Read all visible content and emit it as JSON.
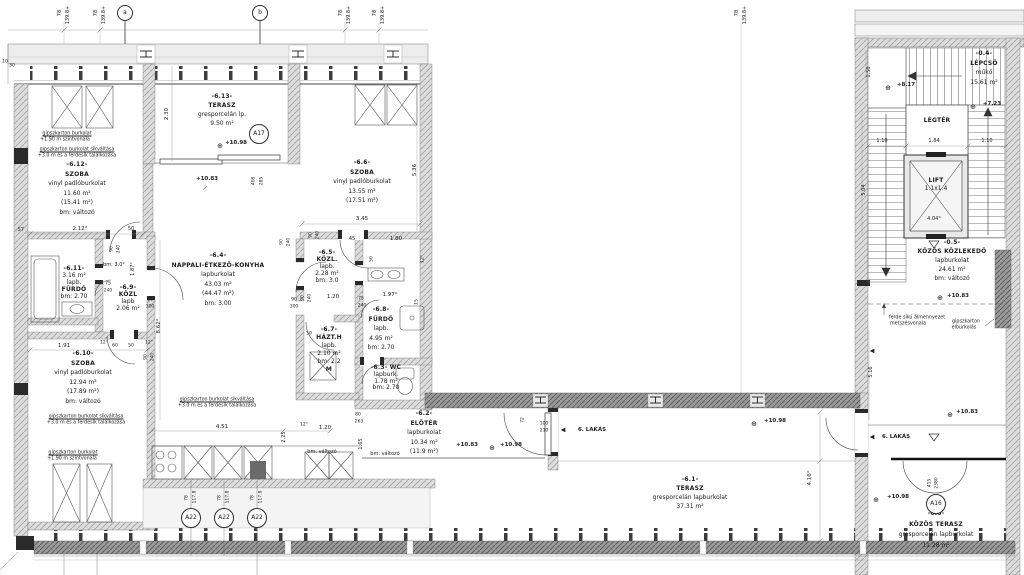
{
  "rooms": [
    {
      "id": "terasz-6-13",
      "x": 222,
      "y": 92,
      "lh": 9,
      "bold": [
        0,
        1
      ],
      "lines": [
        "-6.13-",
        "TERASZ",
        "gresporcelán lp.",
        "9.50 m²"
      ]
    },
    {
      "id": "szoba-6-12",
      "x": 77,
      "y": 160,
      "lh": 9.5,
      "bold": [
        0,
        1
      ],
      "lines": [
        "-6.12-",
        "SZOBA",
        "vinyl padlóburkolat",
        "11.60 m²",
        "(15.41 m²)",
        "bm: változó"
      ]
    },
    {
      "id": "szoba-6-6",
      "x": 362,
      "y": 158,
      "lh": 9.5,
      "bold": [
        0,
        1
      ],
      "lines": [
        "-6.6-",
        "SZOBA",
        "vinyl padlóburkolat",
        "13.55 m²",
        "(17.51 m²)"
      ]
    },
    {
      "id": "nappali-6-4",
      "x": 218,
      "y": 251,
      "lh": 9.5,
      "bold": [
        0,
        1
      ],
      "lines": [
        "-6.4-",
        "NAPPALI-ÉTKEZŐ-KONYHA",
        "lapburkolat",
        "43.03 m²",
        "(44.47 m²)",
        "bm: 3.00"
      ]
    },
    {
      "id": "furdo-6-11",
      "x": 74,
      "y": 265,
      "lh": 7,
      "bold": [
        0,
        3
      ],
      "lines": [
        "-6.11-",
        "3.16 m²",
        "lapb.",
        "FÜRDŐ",
        "bm: 2.70"
      ]
    },
    {
      "id": "kozl-6-9",
      "x": 128,
      "y": 284,
      "lh": 7,
      "bold": [
        0,
        1
      ],
      "lines": [
        "-6.9-",
        "KÖZL",
        "lapb",
        "2.06 m²"
      ]
    },
    {
      "id": "szoba-6-10",
      "x": 83,
      "y": 349,
      "lh": 9.5,
      "bold": [
        0,
        1
      ],
      "lines": [
        "-6.10-",
        "SZOBA",
        "vinyl padlóburkolat",
        "12.94 m²",
        "(17.89 m²)",
        "bm: változó"
      ]
    },
    {
      "id": "kozl-6-5",
      "x": 327,
      "y": 249,
      "lh": 7,
      "bold": [
        0,
        1
      ],
      "lines": [
        "-6.5-",
        "KÖZL.",
        "lapb.",
        "2.28 m²",
        "bm: 3.0"
      ]
    },
    {
      "id": "furdo-6-8",
      "x": 381,
      "y": 305,
      "lh": 9.5,
      "bold": [
        0,
        1
      ],
      "lines": [
        "-6.8-",
        "FÜRDŐ",
        "lapb.",
        "4.95 m²",
        "bm: 2.70"
      ]
    },
    {
      "id": "hazt-6-7",
      "x": 329,
      "y": 326,
      "lh": 8,
      "bold": [
        0,
        1,
        5
      ],
      "lines": [
        "-6.7-",
        "HÁZT.H",
        "lapb.",
        "2.10 m²",
        "bm: 2.2",
        "M"
      ]
    },
    {
      "id": "wc-6-3",
      "x": 386,
      "y": 365,
      "lh": 6.8,
      "bold": [
        0
      ],
      "lines": [
        "-6.3- WC",
        "lapburk.",
        "1.78 m²",
        "bm: 2.70"
      ]
    },
    {
      "id": "eloter-6-2",
      "x": 424,
      "y": 409,
      "lh": 9.5,
      "bold": [
        0,
        1
      ],
      "lines": [
        "-6.2-",
        "ELŐTÉR",
        "lapburkolat",
        "10.34 m²",
        "(11.9 m²)"
      ]
    },
    {
      "id": "terasz-6-1",
      "x": 690,
      "y": 475,
      "lh": 9,
      "bold": [
        0,
        1
      ],
      "lines": [
        "-6.1-",
        "TERASZ",
        "gresporcelán lapburkolat",
        "37.31 m²"
      ]
    },
    {
      "id": "lepcso-0-4",
      "x": 984,
      "y": 49,
      "lh": 9.5,
      "bold": [
        0,
        1
      ],
      "lines": [
        "-0.4-",
        "LÉPCSŐ",
        "műkő",
        "15.61 m²"
      ]
    },
    {
      "id": "kozos-kozlekedo-0-5",
      "x": 952,
      "y": 238,
      "lh": 9,
      "bold": [
        0,
        1
      ],
      "lines": [
        "-0.5-",
        "KÖZÖS KÖZLEKEDŐ",
        "lapburkolat",
        "24.61 m²",
        "bm: változó"
      ]
    },
    {
      "id": "kozos-terasz-0-6",
      "x": 936,
      "y": 509,
      "lh": 10.5,
      "bold": [
        0,
        1
      ],
      "lines": [
        "-0.6-",
        "KÖZÖS TERASZ",
        "gresporcelán lapburkolat",
        "11.28 m²"
      ]
    },
    {
      "id": "legter",
      "x": 937,
      "y": 117,
      "lh": 8,
      "bold": [
        0
      ],
      "lines": [
        "LÉGTÉR"
      ]
    },
    {
      "id": "lift",
      "x": 936,
      "y": 177,
      "lh": 7.5,
      "bold": [
        0
      ],
      "lines": [
        "LIFT",
        "1.1x1.4"
      ]
    }
  ],
  "markers": [
    {
      "t": "a",
      "x": 125,
      "y": 13,
      "r": 7
    },
    {
      "t": "b",
      "x": 260,
      "y": 13,
      "r": 7
    },
    {
      "t": "A17",
      "x": 259,
      "y": 134,
      "r": 9
    },
    {
      "t": "A22",
      "x": 191,
      "y": 518,
      "r": 9
    },
    {
      "t": "A22",
      "x": 224,
      "y": 518,
      "r": 9
    },
    {
      "t": "A22",
      "x": 257,
      "y": 518,
      "r": 9
    },
    {
      "t": "A16",
      "x": 936,
      "y": 504,
      "r": 9
    }
  ],
  "annotations": [
    {
      "t": "78",
      "x": 60,
      "y": 13,
      "r": 1,
      "s": 5
    },
    {
      "t": "139.8+",
      "x": 68,
      "y": 15,
      "r": 1,
      "s": 5
    },
    {
      "t": "78",
      "x": 96,
      "y": 13,
      "r": 1,
      "s": 5
    },
    {
      "t": "139.8+",
      "x": 104,
      "y": 15,
      "r": 1,
      "s": 5
    },
    {
      "t": "78",
      "x": 341,
      "y": 13,
      "r": 1,
      "s": 5
    },
    {
      "t": "139.8+",
      "x": 349,
      "y": 15,
      "r": 1,
      "s": 5
    },
    {
      "t": "78",
      "x": 375,
      "y": 13,
      "r": 1,
      "s": 5
    },
    {
      "t": "139.8+",
      "x": 383,
      "y": 15,
      "r": 1,
      "s": 5
    },
    {
      "t": "78",
      "x": 737,
      "y": 13,
      "r": 1,
      "s": 5
    },
    {
      "t": "139.8+",
      "x": 745,
      "y": 15,
      "r": 1,
      "s": 5
    },
    {
      "t": "10",
      "x": 5,
      "y": 62,
      "s": 4.5
    },
    {
      "t": "30",
      "x": 12,
      "y": 66,
      "s": 4.5
    },
    {
      "t": "2.30",
      "x": 167,
      "y": 114,
      "r": 1
    },
    {
      "t": "⊕",
      "x": 220,
      "y": 146,
      "s": 7,
      "n": "level-marker"
    },
    {
      "t": "+10.98",
      "x": 236,
      "y": 143,
      "b": 1,
      "n": "level-value"
    },
    {
      "t": "+10.83",
      "x": 207,
      "y": 179,
      "b": 1,
      "n": "level-value"
    },
    {
      "t": "408",
      "x": 254,
      "y": 181,
      "r": 1,
      "s": 4.5
    },
    {
      "t": "285",
      "x": 262,
      "y": 181,
      "r": 1,
      "s": 4.5
    },
    {
      "t": ".57",
      "x": 20,
      "y": 230,
      "s": 5
    },
    {
      "t": "2.12°",
      "x": 80,
      "y": 229
    },
    {
      "t": "50",
      "x": 131,
      "y": 229,
      "s": 5
    },
    {
      "t": "90",
      "x": 112,
      "y": 249,
      "r": 1,
      "s": 4.5
    },
    {
      "t": "240",
      "x": 119,
      "y": 249,
      "r": 1,
      "s": 4.5
    },
    {
      "t": "3.45",
      "x": 362,
      "y": 219
    },
    {
      "t": "5.36",
      "x": 415,
      "y": 170,
      "r": 1
    },
    {
      "t": "45",
      "x": 352,
      "y": 239,
      "s": 5
    },
    {
      "t": "1.80",
      "x": 396,
      "y": 239
    },
    {
      "t": "90",
      "x": 311,
      "y": 235,
      "r": 1,
      "s": 4.5
    },
    {
      "t": "240",
      "x": 318,
      "y": 235,
      "r": 1,
      "s": 4.5
    },
    {
      "t": "50",
      "x": 372,
      "y": 259,
      "r": 1,
      "s": 4.5
    },
    {
      "t": "12°",
      "x": 423,
      "y": 259,
      "r": 1,
      "s": 4.5
    },
    {
      "t": "90",
      "x": 282,
      "y": 242,
      "r": 1,
      "s": 4.5
    },
    {
      "t": "240",
      "x": 289,
      "y": 242,
      "r": 1,
      "s": 4.5
    },
    {
      "t": "1.20",
      "x": 333,
      "y": 297
    },
    {
      "t": "90",
      "x": 294,
      "y": 300,
      "s": 4.5
    },
    {
      "t": "300",
      "x": 294,
      "y": 307,
      "s": 4.5
    },
    {
      "t": "75",
      "x": 361,
      "y": 299,
      "s": 4.5
    },
    {
      "t": "240",
      "x": 362,
      "y": 306,
      "s": 4.5
    },
    {
      "t": "1.97°",
      "x": 390,
      "y": 295
    },
    {
      "t": "15",
      "x": 417,
      "y": 302,
      "r": 1,
      "s": 4.5
    },
    {
      "t": "bm: 3.0°",
      "x": 114,
      "y": 265,
      "s": 5
    },
    {
      "t": "1.87°",
      "x": 133,
      "y": 269,
      "r": 1,
      "s": 5
    },
    {
      "t": "75",
      "x": 108,
      "y": 284,
      "s": 4.5
    },
    {
      "t": "240",
      "x": 108,
      "y": 291,
      "s": 4.5
    },
    {
      "t": "90",
      "x": 150,
      "y": 300,
      "s": 4.5
    },
    {
      "t": "300",
      "x": 150,
      "y": 307,
      "s": 4.5
    },
    {
      "t": "8.62°",
      "x": 159,
      "y": 326,
      "r": 1
    },
    {
      "t": "90",
      "x": 303,
      "y": 298,
      "r": 1,
      "s": 4.5
    },
    {
      "t": "240",
      "x": 310,
      "y": 298,
      "r": 1,
      "s": 4.5
    },
    {
      "t": "50",
      "x": 309,
      "y": 334,
      "s": 4.5
    },
    {
      "t": "1.91",
      "x": 64,
      "y": 346
    },
    {
      "t": "12°",
      "x": 104,
      "y": 343,
      "s": 4.5
    },
    {
      "t": "60",
      "x": 115,
      "y": 346,
      "s": 4.5
    },
    {
      "t": "50",
      "x": 131,
      "y": 346,
      "s": 4.5
    },
    {
      "t": "12°",
      "x": 149,
      "y": 343,
      "s": 4.5
    },
    {
      "t": "90",
      "x": 146,
      "y": 357,
      "r": 1,
      "s": 4.5
    },
    {
      "t": "240",
      "x": 153,
      "y": 357,
      "r": 1,
      "s": 4.5
    },
    {
      "t": "gipszkarton burkolat",
      "x": 67,
      "y": 134,
      "s": 4.8,
      "u": 1
    },
    {
      "t": "+1.90 m szintvonala",
      "x": 65,
      "y": 140,
      "s": 4.8
    },
    {
      "t": "gipszkarton burkolat síkváltása",
      "x": 77,
      "y": 150,
      "s": 4.8,
      "u": 1
    },
    {
      "t": "+3.0 m és a ferdesík találkozása",
      "x": 77,
      "y": 156,
      "s": 4.8
    },
    {
      "t": "gipszkarton burkolat síkváltása",
      "x": 217,
      "y": 400,
      "s": 4.8,
      "u": 1
    },
    {
      "t": "+3.0 m és a ferdesík találkozása",
      "x": 217,
      "y": 406,
      "s": 4.8
    },
    {
      "t": "gipszkarton burkolat síkváltása",
      "x": 86,
      "y": 417,
      "s": 4.8,
      "u": 1
    },
    {
      "t": "+3.0 m és a ferdesík találkozása",
      "x": 86,
      "y": 423,
      "s": 4.8
    },
    {
      "t": "gipszkarton burkolat",
      "x": 73,
      "y": 453,
      "s": 4.8,
      "u": 1
    },
    {
      "t": "+1.90 m szintvonala",
      "x": 72,
      "y": 459,
      "s": 4.8
    },
    {
      "t": "4.51",
      "x": 222,
      "y": 427
    },
    {
      "t": "12°",
      "x": 304,
      "y": 425,
      "s": 4.5
    },
    {
      "t": "1.20",
      "x": 325,
      "y": 428
    },
    {
      "t": "80",
      "x": 358,
      "y": 415,
      "s": 4.5
    },
    {
      "t": "263",
      "x": 359,
      "y": 422,
      "s": 4.5
    },
    {
      "t": "2.25",
      "x": 284,
      "y": 437,
      "r": 1,
      "s": 5
    },
    {
      "t": "1.65",
      "x": 361,
      "y": 444,
      "r": 1,
      "s": 5
    },
    {
      "t": "bm: változó",
      "x": 322,
      "y": 452,
      "s": 5
    },
    {
      "t": "bm: változó",
      "x": 385,
      "y": 454,
      "s": 5
    },
    {
      "t": "78",
      "x": 187,
      "y": 498,
      "r": 1,
      "s": 4.5
    },
    {
      "t": "117.8",
      "x": 195,
      "y": 497,
      "r": 1,
      "s": 4.5
    },
    {
      "t": "78",
      "x": 220,
      "y": 498,
      "r": 1,
      "s": 4.5
    },
    {
      "t": "117.8",
      "x": 228,
      "y": 497,
      "r": 1,
      "s": 4.5
    },
    {
      "t": "78",
      "x": 253,
      "y": 498,
      "r": 1,
      "s": 4.5
    },
    {
      "t": "117.8",
      "x": 261,
      "y": 497,
      "r": 1,
      "s": 4.5
    },
    {
      "t": "+10.83",
      "x": 467,
      "y": 445,
      "b": 1,
      "n": "level-value"
    },
    {
      "t": "⊕",
      "x": 492,
      "y": 448,
      "s": 7,
      "n": "level-marker"
    },
    {
      "t": "+10.98",
      "x": 511,
      "y": 445,
      "b": 1,
      "n": "level-value"
    },
    {
      "t": "72",
      "x": 523,
      "y": 420,
      "r": 1,
      "s": 4.5
    },
    {
      "t": "100",
      "x": 544,
      "y": 424,
      "s": 4.5
    },
    {
      "t": "210",
      "x": 544,
      "y": 431,
      "s": 4.5
    },
    {
      "t": "◀",
      "x": 563,
      "y": 430,
      "s": 6,
      "n": "apartment-arrow"
    },
    {
      "t": "6. LAKÁS",
      "x": 592,
      "y": 430,
      "b": 1,
      "n": "apartment-label"
    },
    {
      "t": "⊕",
      "x": 754,
      "y": 424,
      "s": 7,
      "n": "level-marker"
    },
    {
      "t": "+10.98",
      "x": 775,
      "y": 421,
      "b": 1,
      "n": "level-value"
    },
    {
      "t": "4.16°",
      "x": 810,
      "y": 478,
      "r": 1
    },
    {
      "t": "1.50",
      "x": 869,
      "y": 72,
      "r": 1,
      "s": 5
    },
    {
      "t": "⊕",
      "x": 888,
      "y": 88,
      "s": 7,
      "n": "level-marker"
    },
    {
      "t": "+8.17",
      "x": 906,
      "y": 85,
      "b": 1,
      "n": "level-value"
    },
    {
      "t": "⊕",
      "x": 973,
      "y": 107,
      "s": 7,
      "n": "level-marker"
    },
    {
      "t": "+7.23",
      "x": 992,
      "y": 104,
      "b": 1,
      "n": "level-value"
    },
    {
      "t": "1.10",
      "x": 882,
      "y": 141,
      "s": 5
    },
    {
      "t": "1.84",
      "x": 934,
      "y": 141,
      "s": 5
    },
    {
      "t": "1.10",
      "x": 987,
      "y": 141,
      "s": 5
    },
    {
      "t": "5.04",
      "x": 864,
      "y": 190,
      "r": 1,
      "s": 5
    },
    {
      "t": "4.04°",
      "x": 934,
      "y": 219,
      "s": 5
    },
    {
      "t": "⊕",
      "x": 940,
      "y": 298,
      "s": 7,
      "n": "level-marker"
    },
    {
      "t": "+10.83",
      "x": 958,
      "y": 296,
      "b": 1,
      "n": "level-value"
    },
    {
      "t": "ferde síkú álmennyezet",
      "x": 917,
      "y": 318,
      "s": 4.8
    },
    {
      "t": "metszésvonala",
      "x": 908,
      "y": 324,
      "s": 4.8
    },
    {
      "t": "gipszkarton",
      "x": 966,
      "y": 322,
      "s": 4.8
    },
    {
      "t": "elburkolás",
      "x": 964,
      "y": 328,
      "s": 4.8
    },
    {
      "t": "◀",
      "x": 872,
      "y": 351,
      "s": 6,
      "n": "direction-arrow"
    },
    {
      "t": "5.16",
      "x": 871,
      "y": 372,
      "r": 1,
      "s": 5
    },
    {
      "t": "+10.83",
      "x": 967,
      "y": 412,
      "b": 1,
      "n": "level-value"
    },
    {
      "t": "⊕",
      "x": 950,
      "y": 415,
      "s": 7,
      "n": "level-marker"
    },
    {
      "t": "◀",
      "x": 872,
      "y": 437,
      "s": 6,
      "n": "apartment-arrow"
    },
    {
      "t": "6. LAKÁS",
      "x": 896,
      "y": 437,
      "b": 1,
      "n": "apartment-label"
    },
    {
      "t": "415",
      "x": 930,
      "y": 483,
      "r": 1,
      "s": 4.5
    },
    {
      "t": "2380",
      "x": 937,
      "y": 483,
      "r": 1,
      "s": 4.5
    },
    {
      "t": "⊕",
      "x": 876,
      "y": 500,
      "s": 7,
      "n": "level-marker"
    },
    {
      "t": "+10.98",
      "x": 898,
      "y": 497,
      "b": 1,
      "n": "level-value"
    }
  ]
}
